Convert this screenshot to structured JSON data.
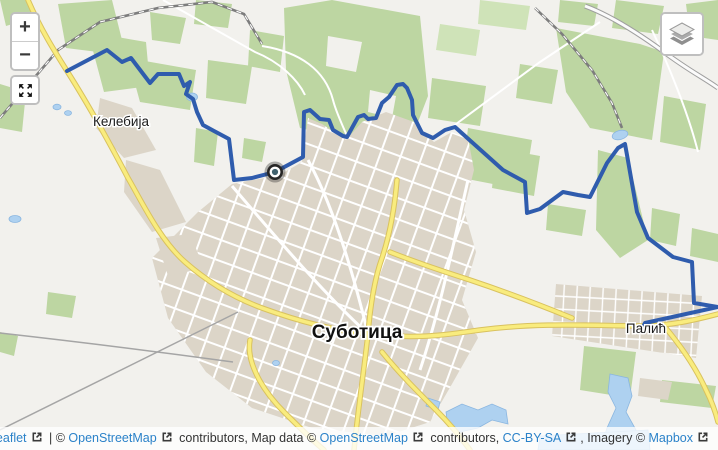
{
  "map": {
    "places": [
      {
        "name": "Келебија",
        "x": 121,
        "y": 126,
        "size": "small"
      },
      {
        "name": "Суботица",
        "x": 357,
        "y": 338,
        "size": "large"
      },
      {
        "name": "Палић",
        "x": 646,
        "y": 333,
        "size": "small"
      }
    ],
    "route": {
      "color": "#2f5cad",
      "width": 4,
      "points": [
        [
          67,
          71
        ],
        [
          107,
          50
        ],
        [
          122,
          62
        ],
        [
          131,
          58
        ],
        [
          150,
          83
        ],
        [
          158,
          74
        ],
        [
          179,
          74
        ],
        [
          184,
          86
        ],
        [
          190,
          82
        ],
        [
          186,
          94
        ],
        [
          193,
          99
        ],
        [
          197,
          112
        ],
        [
          203,
          125
        ],
        [
          214,
          131
        ],
        [
          229,
          139
        ],
        [
          234,
          180
        ],
        [
          252,
          178
        ],
        [
          275,
          172
        ],
        [
          303,
          157
        ],
        [
          304,
          112
        ],
        [
          310,
          110
        ],
        [
          320,
          119
        ],
        [
          329,
          120
        ],
        [
          333,
          130
        ],
        [
          343,
          136
        ],
        [
          347,
          137
        ],
        [
          358,
          117
        ],
        [
          364,
          115
        ],
        [
          368,
          119
        ],
        [
          376,
          118
        ],
        [
          382,
          103
        ],
        [
          389,
          97
        ],
        [
          397,
          85
        ],
        [
          403,
          84
        ],
        [
          407,
          88
        ],
        [
          412,
          100
        ],
        [
          413,
          115
        ],
        [
          422,
          133
        ],
        [
          433,
          138
        ],
        [
          445,
          130
        ],
        [
          455,
          127
        ],
        [
          503,
          170
        ],
        [
          525,
          182
        ],
        [
          527,
          213
        ],
        [
          540,
          209
        ],
        [
          563,
          192
        ],
        [
          578,
          195
        ],
        [
          590,
          197
        ],
        [
          607,
          163
        ],
        [
          618,
          148
        ],
        [
          625,
          144
        ],
        [
          627,
          155
        ],
        [
          637,
          212
        ],
        [
          648,
          238
        ],
        [
          673,
          257
        ],
        [
          692,
          262
        ],
        [
          694,
          303
        ],
        [
          718,
          307
        ],
        [
          645,
          323
        ],
        [
          641,
          331
        ]
      ]
    },
    "marker": {
      "x": 275,
      "y": 172
    }
  },
  "controls": {
    "zoom_in": "+",
    "zoom_out": "−"
  },
  "attribution": {
    "segments": [
      {
        "type": "link",
        "label": "Leaflet"
      },
      {
        "type": "text",
        "label": " | © "
      },
      {
        "type": "link",
        "label": "OpenStreetMap"
      },
      {
        "type": "text",
        "label": " contributors, Map data © "
      },
      {
        "type": "link",
        "label": "OpenStreetMap"
      },
      {
        "type": "text",
        "label": " contributors, "
      },
      {
        "type": "link",
        "label": "CC-BY-SA"
      },
      {
        "type": "text",
        "label": ", Imagery © "
      },
      {
        "type": "link",
        "label": "Mapbox"
      }
    ]
  },
  "colors": {
    "background": "#f2f1ed",
    "forest": "#bdd6a2",
    "urban": "#dcd5c8",
    "water": "#aed1f0",
    "road_major": "#f9ec7e",
    "link": "#2b82c9"
  }
}
